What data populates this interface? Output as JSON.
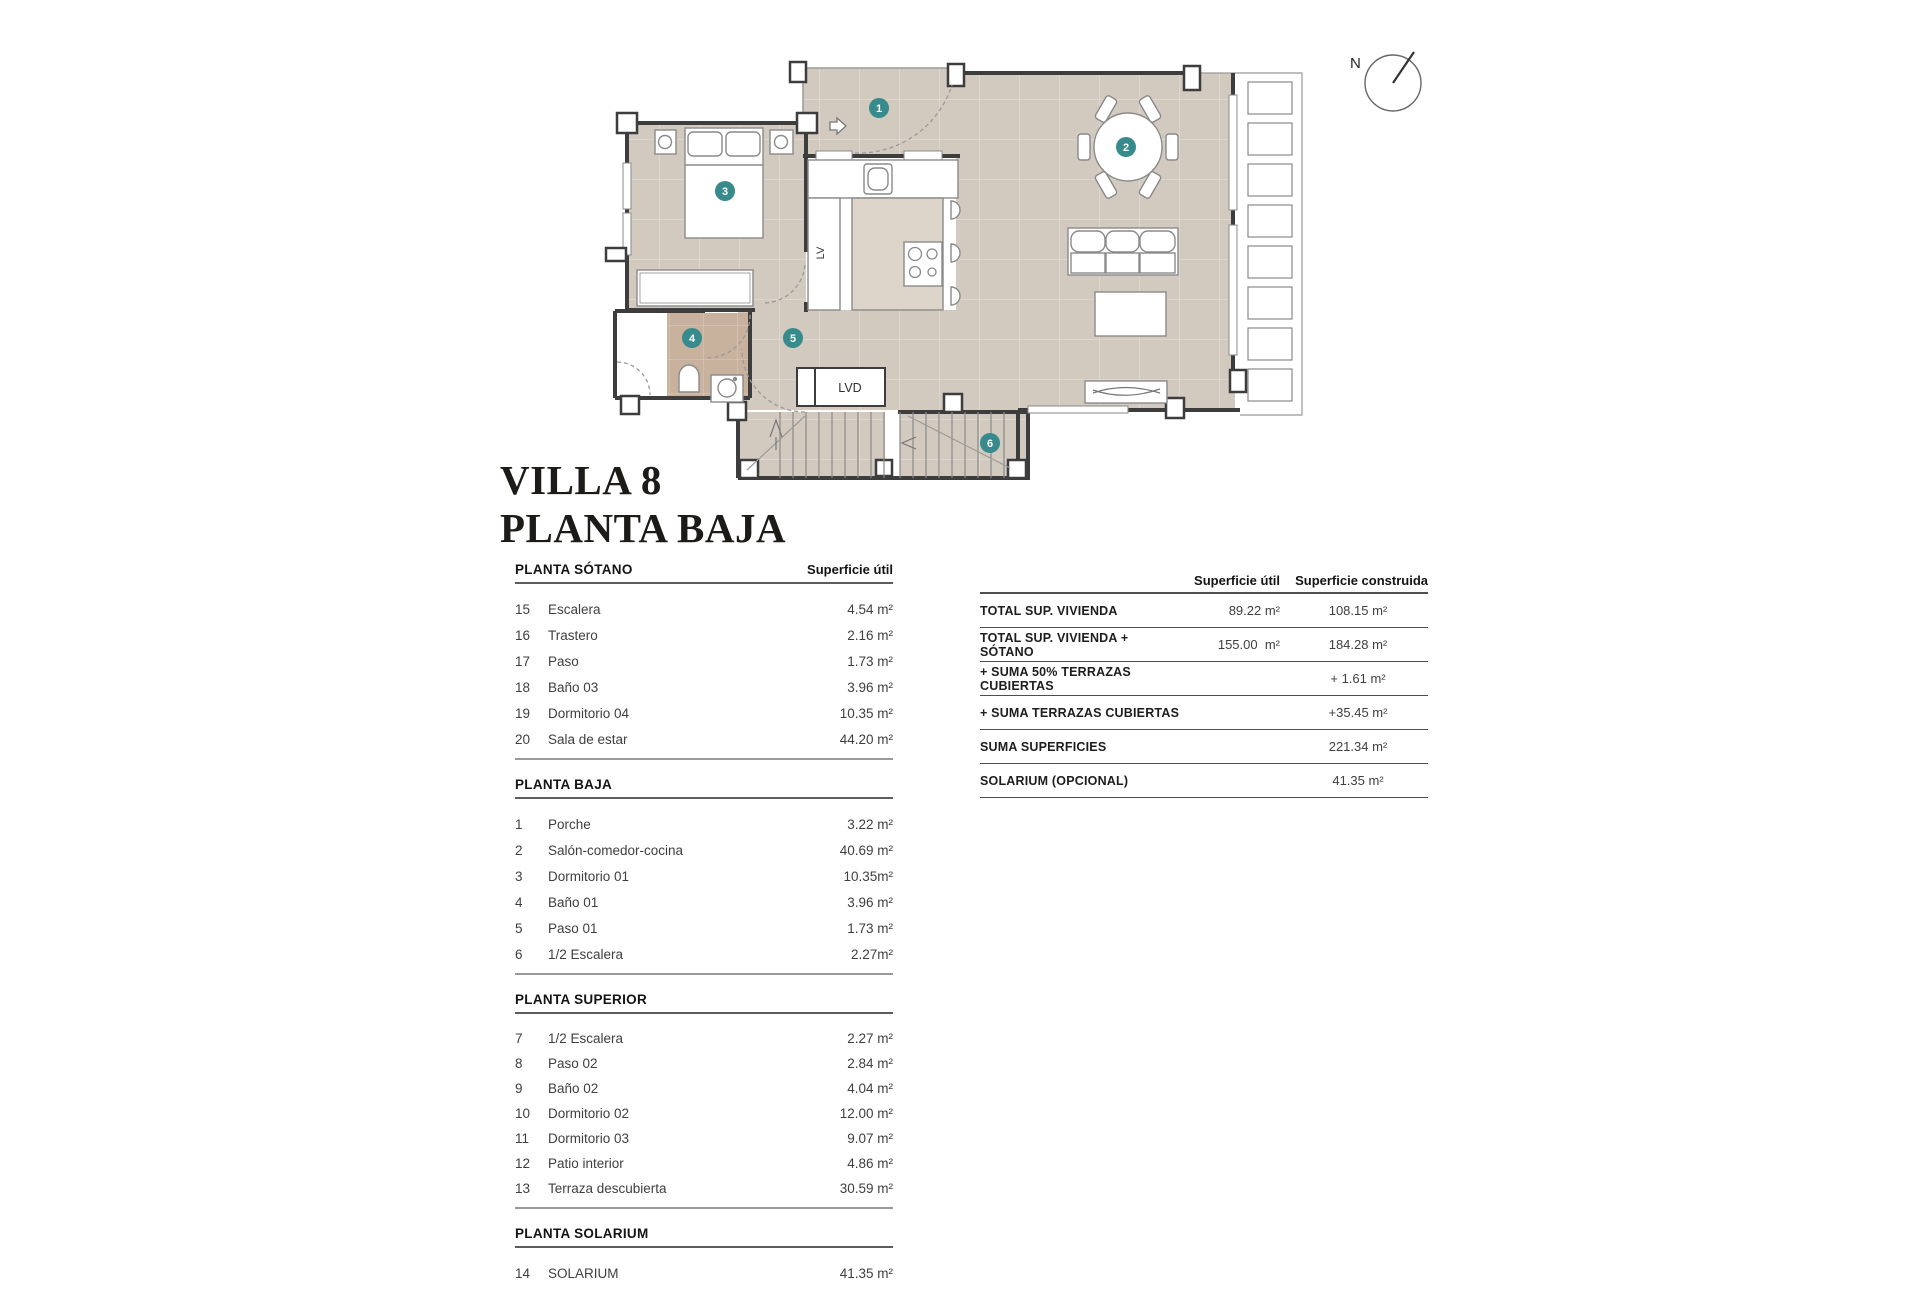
{
  "title": {
    "line1": "VILLA 8",
    "line2": "PLANTA BAJA"
  },
  "compass": {
    "label": "N"
  },
  "plan": {
    "markers": [
      "1",
      "2",
      "3",
      "4",
      "5",
      "6"
    ],
    "labels": {
      "lv": "LV",
      "lvd": "LVD"
    },
    "colors": {
      "floor": "#d3cabf",
      "bath_floor": "#c8b19d",
      "island": "#ddd5c9",
      "wall": "#3d3d3d",
      "outline": "#8a8a8a",
      "marker": "#378b8d"
    }
  },
  "left_table": {
    "area_header": "Superficie útil",
    "sections": [
      {
        "name": "PLANTA SÓTANO",
        "rows": [
          [
            "15",
            "Escalera",
            "4.54 m²"
          ],
          [
            "16",
            "Trastero",
            "2.16 m²"
          ],
          [
            "17",
            "Paso",
            "1.73 m²"
          ],
          [
            "18",
            "Baño 03",
            "3.96 m²"
          ],
          [
            "19",
            "Dormitorio 04",
            "10.35 m²"
          ],
          [
            "20",
            "Sala de estar",
            "44.20 m²"
          ]
        ]
      },
      {
        "name": "PLANTA BAJA",
        "rows": [
          [
            "1",
            "Porche",
            "3.22 m²"
          ],
          [
            "2",
            "Salón-comedor-cocina",
            "40.69 m²"
          ],
          [
            "3",
            "Dormitorio 01",
            "10.35m²"
          ],
          [
            "4",
            "Baño 01",
            "3.96 m²"
          ],
          [
            "5",
            "Paso 01",
            "1.73 m²"
          ],
          [
            "6",
            "1/2 Escalera",
            "2.27m²"
          ]
        ]
      },
      {
        "name": "PLANTA SUPERIOR",
        "rows": [
          [
            "7",
            "1/2 Escalera",
            "2.27 m²"
          ],
          [
            "8",
            "Paso 02",
            "2.84 m²"
          ],
          [
            "9",
            "Baño 02",
            "4.04 m²"
          ],
          [
            "10",
            "Dormitorio 02",
            "12.00 m²"
          ],
          [
            "11",
            "Dormitorio 03",
            "9.07 m²"
          ],
          [
            "12",
            "Patio interior",
            "4.86 m²"
          ],
          [
            "13",
            "Terraza descubierta",
            "30.59 m²"
          ]
        ]
      },
      {
        "name": "PLANTA SOLARIUM",
        "rows": [
          [
            "14",
            "SOLARIUM",
            "41.35 m²"
          ]
        ]
      }
    ]
  },
  "right_table": {
    "col1": "Superficie útil",
    "col2": "Superficie construida",
    "rows": [
      {
        "label": "TOTAL SUP. VIVIENDA",
        "util": "89.22 m²",
        "construida": "108.15 m²"
      },
      {
        "label": "TOTAL SUP. VIVIENDA + SÓTANO",
        "util": "155.00  m²",
        "construida": "184.28 m²"
      },
      {
        "label": "+ SUMA 50% TERRAZAS CUBIERTAS",
        "util": "",
        "construida": "+ 1.61 m²"
      },
      {
        "label": "+ SUMA TERRAZAS CUBIERTAS",
        "util": "",
        "construida": "+35.45 m²"
      },
      {
        "label": "SUMA SUPERFICIES",
        "util": "",
        "construida": "221.34 m²"
      },
      {
        "label": "SOLARIUM (OPCIONAL)",
        "util": "",
        "construida": "41.35 m²"
      }
    ]
  }
}
